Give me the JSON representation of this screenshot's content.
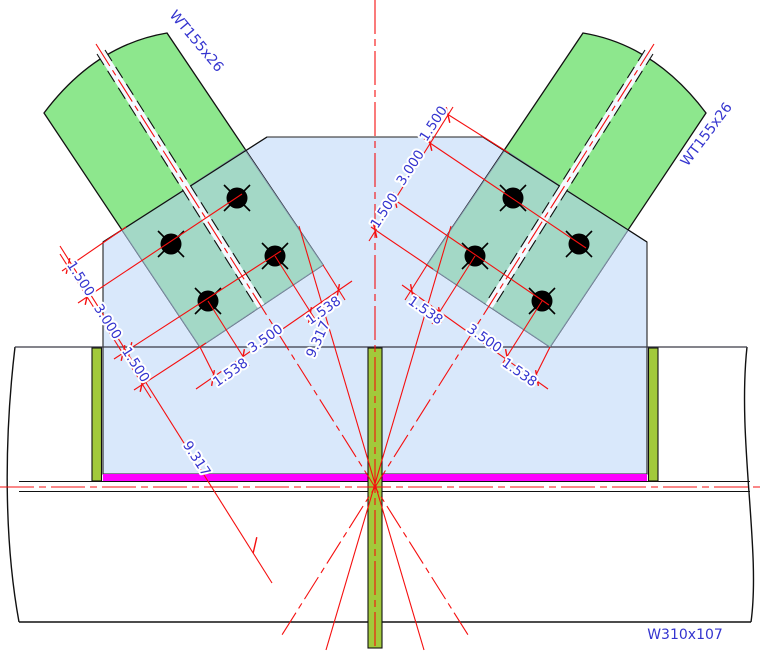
{
  "drawing": {
    "type": "structural-connection-detail",
    "members": {
      "brace_left": "WT155x26",
      "brace_right": "WT155x26",
      "beam": "W310x107"
    },
    "member_labels": [
      {
        "text": "WT155x26",
        "x": 193,
        "y": 44,
        "rot": 50
      },
      {
        "text": "WT155x26",
        "x": 710,
        "y": 137,
        "rot": -53
      },
      {
        "text": "W310x107",
        "x": 685,
        "y": 639,
        "rot": 0
      }
    ],
    "dimension_labels": [
      {
        "text": "1.500",
        "x": 77,
        "y": 281,
        "rot": 57
      },
      {
        "text": "3.000",
        "x": 104,
        "y": 324,
        "rot": 57
      },
      {
        "text": "1.500",
        "x": 132,
        "y": 367,
        "rot": 57
      },
      {
        "text": "1.500",
        "x": 437,
        "y": 126,
        "rot": -57
      },
      {
        "text": "3.000",
        "x": 414,
        "y": 170,
        "rot": -57
      },
      {
        "text": "1.500",
        "x": 388,
        "y": 213,
        "rot": -57
      },
      {
        "text": "1.538",
        "x": 326,
        "y": 314,
        "rot": -35
      },
      {
        "text": "3.500",
        "x": 268,
        "y": 342,
        "rot": -35
      },
      {
        "text": "1.538",
        "x": 233,
        "y": 376,
        "rot": -35
      },
      {
        "text": "1.538",
        "x": 423,
        "y": 314,
        "rot": 35
      },
      {
        "text": "3.500",
        "x": 482,
        "y": 342,
        "rot": 35
      },
      {
        "text": "1.538",
        "x": 517,
        "y": 376,
        "rot": 35
      },
      {
        "text": "9.317",
        "x": 193,
        "y": 461,
        "rot": 57
      },
      {
        "text": "9.317",
        "x": 322,
        "y": 341,
        "rot": -66
      }
    ],
    "colors": {
      "gusset_plate": "#d9e8fb",
      "brace_fill": "#8de78d",
      "brace_overlap": "#a3d8c6",
      "stiffener": "#a2c93b",
      "weld_highlight": "#ff00ff",
      "dimension_line": "#f50f0f",
      "annotation_text": "#3434cf",
      "outline": "#111111"
    },
    "bolts": {
      "count": 8,
      "left_group": [
        [
          237,
          198
        ],
        [
          171,
          244
        ],
        [
          275,
          256
        ],
        [
          208,
          301
        ]
      ],
      "right_group": [
        [
          513,
          198
        ],
        [
          579,
          244
        ],
        [
          475,
          256
        ],
        [
          542,
          301
        ]
      ]
    }
  }
}
